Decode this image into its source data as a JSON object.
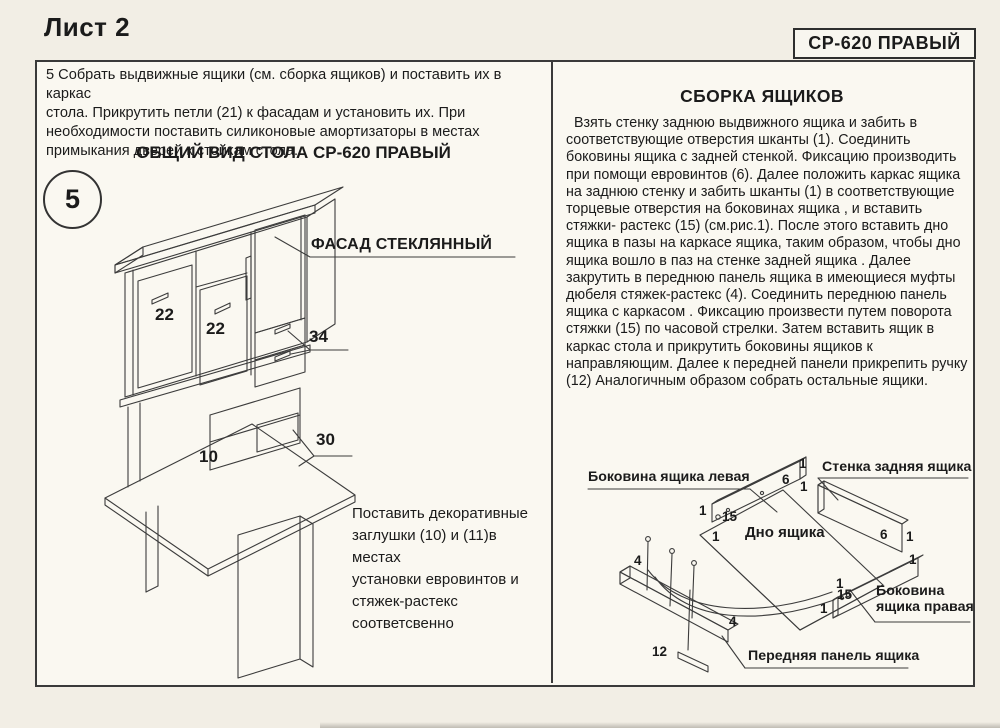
{
  "page": {
    "sheet_title": "Лист 2",
    "model_badge": "СР-620 ПРАВЫЙ"
  },
  "left_panel": {
    "step_text": "5 Собрать выдвижные ящики (см. сборка ящиков) и поставить их в каркас\nстола. Прикрутить петли (21) к фасадам и установить их. При\nнеобходимости поставить силиконовые амортизаторы в местах\nпримыкания дверей к стойкам стола.",
    "drawing_title": "ОБЩИЙ ВИД СТОЛА СР-620 ПРАВЫЙ",
    "step_number": "5",
    "glass_facade_label": "ФАСАД СТЕКЛЯННЫЙ",
    "note_text": "Поставить декоративные\nзаглушки (10) и (11)в местах\nустановки евровинтов и\nстяжек-растекс\nсоответсвенно",
    "callouts": {
      "door_left": "22",
      "door_middle": "22",
      "upper_drawers": "34",
      "lower_drawer": "30",
      "desktop": "10"
    }
  },
  "right_panel": {
    "heading": "СБОРКА ЯЩИКОВ",
    "body_text": "  Взять стенку заднюю выдвижного ящика и забить в\nсоответствующие отверстия шканты (1). Соединить\nбоковины ящика с задней стенкой. Фиксацию производить\nпри помощи евровинтов (6). Далее положить каркас ящика\nна заднюю стенку и забить шканты (1) в соответствующие\nторцевые отверстия на боковинах ящика , и вставить\nстяжки- растекс (15) (см.рис.1). После этого вставить дно\nящика в пазы на каркасе ящика, таким образом, чтобы дно\nящика вошло в паз на стенке задней ящика . Далее\nзакрутить в переднюю панель ящика в имеющиеся муфты\nдюбеля стяжек-растекс (4). Соединить переднюю панель\nящика с каркасом . Фиксацию произвести путем поворота\nстяжки (15) по часовой стрелки. Затем вставить ящик в\nкаркас стола и прикрутить боковины ящиков к\nнаправляющим. Далее к передней панели прикрепить ручку\n(12) Аналогичным образом собрать остальные ящики.",
    "labels": {
      "side_left": "Боковина ящика левая",
      "back_wall": "Стенка задняя ящика",
      "bottom": "Дно ящика",
      "side_right": "Боковина\nящика правая",
      "front_panel": "Передняя панель ящика"
    },
    "callouts": [
      "1",
      "6",
      "1",
      "1",
      "15",
      "1",
      "6",
      "1",
      "1",
      "1",
      "15",
      "1",
      "4",
      "4",
      "12"
    ]
  }
}
